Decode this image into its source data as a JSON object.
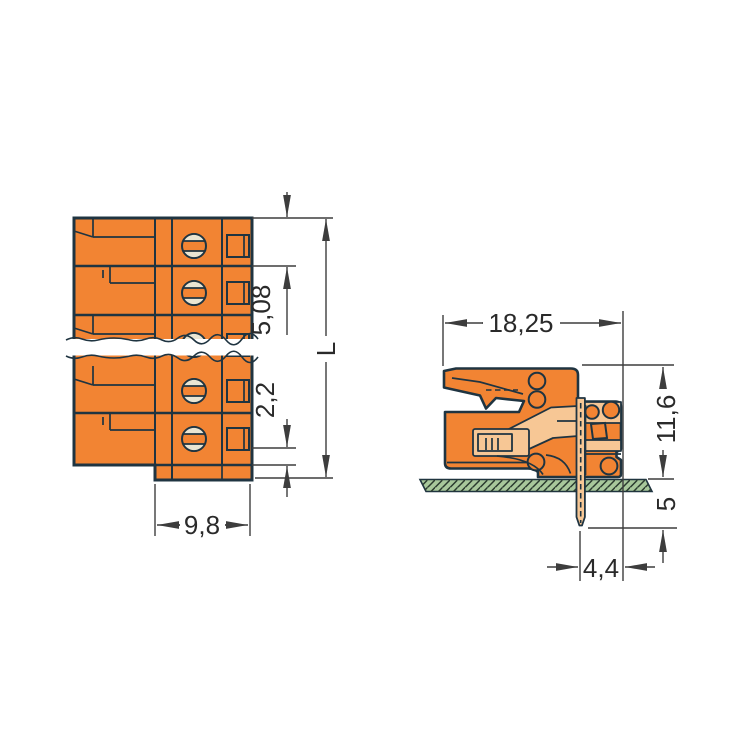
{
  "drawing": {
    "kind": "connector-technical-dimension-drawing",
    "front_view": {
      "dimensions": {
        "pin_spacing": "5,08",
        "edge_offset": "2,2",
        "total_length": "L",
        "block_width": "9,8"
      }
    },
    "side_view": {
      "dimensions": {
        "depth": "18,25",
        "height_above_board": "11,6",
        "pin_length_below_board": "5",
        "pin_to_edge": "4,4"
      }
    },
    "colors": {
      "housing_orange": "#F28433",
      "contact_light_orange": "#F7C795",
      "screw_slot_cream": "#EAE5D2",
      "outline_dark": "#1F3441",
      "board_green": "#A8C89B",
      "dimension_line": "#3D3D3D",
      "dimension_text": "#2A2A2A",
      "background": "#FFFFFF"
    }
  }
}
